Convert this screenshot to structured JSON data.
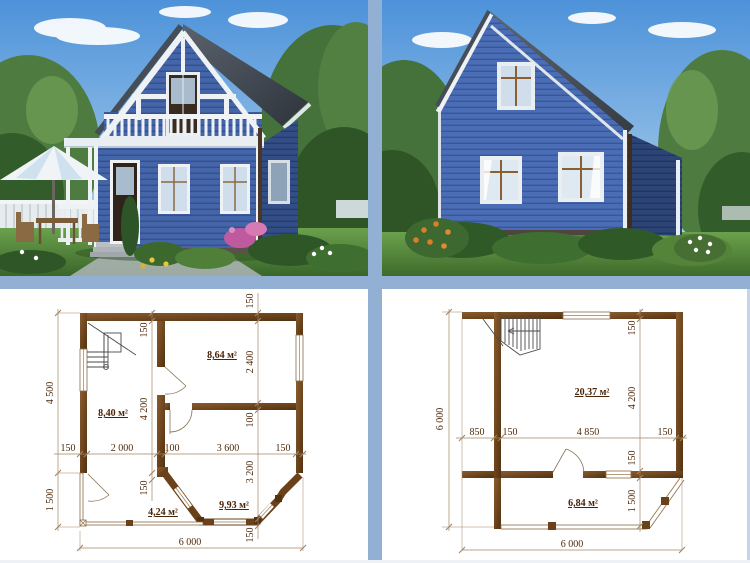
{
  "layout": {
    "divider_color": "#92b0d4",
    "background": "#ffffff"
  },
  "photos": {
    "front": {
      "name": "house-front-view-render",
      "siding_color": "#4565a9",
      "roof_color": "#414952",
      "trim_color": "#eef2f5"
    },
    "rear": {
      "name": "house-rear-view-render",
      "siding_color": "#4a6db6",
      "roof_color": "#49505a",
      "trim_color": "#eef2f5"
    }
  },
  "plans": {
    "first_floor": {
      "rooms": [
        {
          "area": "8,64 м²"
        },
        {
          "area": "8,40 м²"
        },
        {
          "area": "4,24 м²"
        },
        {
          "area": "9,93 м²"
        }
      ],
      "dims": {
        "left_upper": "4 500",
        "left_lower": "1 500",
        "mid_top": "150",
        "mid_main": "4 200",
        "mid_bottom": "150",
        "right_1": "150",
        "right_2": "2 400",
        "right_3": "100",
        "right_4": "3 200",
        "right_5": "150",
        "h_1": "150",
        "h_2": "2 000",
        "h_3": "100",
        "h_4": "3 600",
        "h_5": "150",
        "bottom_total": "6 000"
      }
    },
    "second_floor": {
      "rooms": [
        {
          "area": "20,37 м²"
        },
        {
          "area": "6,84 м²"
        }
      ],
      "dims": {
        "left_total": "6 000",
        "right_1": "150",
        "right_2": "4 200",
        "right_3": "150",
        "right_4": "1 500",
        "h_1": "850",
        "h_2": "150",
        "h_3": "4 850",
        "h_4": "150",
        "bottom_total": "6 000"
      }
    }
  }
}
